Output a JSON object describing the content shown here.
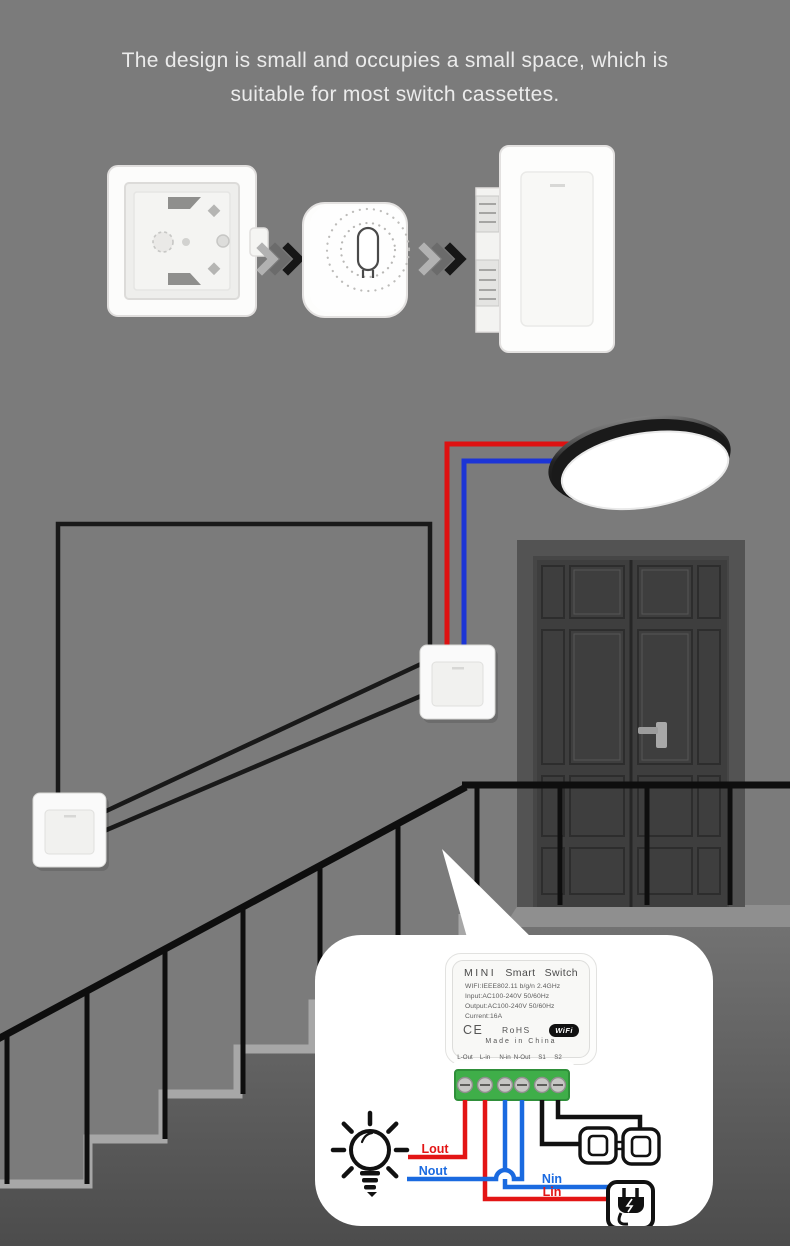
{
  "heading": {
    "line1": "The design is small and occupies a small space, which is",
    "line2": "suitable for most switch cassettes."
  },
  "callout": {
    "device": {
      "title": [
        "MINI",
        "Smart",
        "Switch"
      ],
      "specs": [
        "WIFI:IEEE802.11 b/g/n 2.4GHz",
        "Input:AC100-240V 50/60Hz",
        "Output:AC100-240V 50/60Hz",
        "Current:16A"
      ],
      "ce": "CE",
      "rohs": "RoHS",
      "wifi": "WiFi",
      "made_in": "Made in China",
      "terminals": [
        "L-Out",
        "L-in",
        "N-in",
        "N-Out",
        "S1",
        "S2"
      ]
    },
    "labels": {
      "lout": "Lout",
      "nout": "Nout",
      "nin": "Nin",
      "lin": "Lin"
    }
  },
  "icons": {
    "bulb": "light-bulb-icon",
    "plug": "power-plug-icon",
    "switch_pair": "two-wall-switches-icon",
    "wifi": "wifi-logo",
    "ce": "ce-mark",
    "arrow": "triple-chevron-right-arrow"
  },
  "colors": {
    "background": "#7b7b7b",
    "heading_text": "#ebebeb",
    "wire_red": "#de1111",
    "wire_blue": "#1c35d6",
    "wire_black": "#191919",
    "diagram_red": "#e31515",
    "diagram_blue": "#1a6ae0",
    "terminal_green": "#3fae49",
    "bubble": "#ffffff",
    "step_edge": "#a7a7a7"
  }
}
